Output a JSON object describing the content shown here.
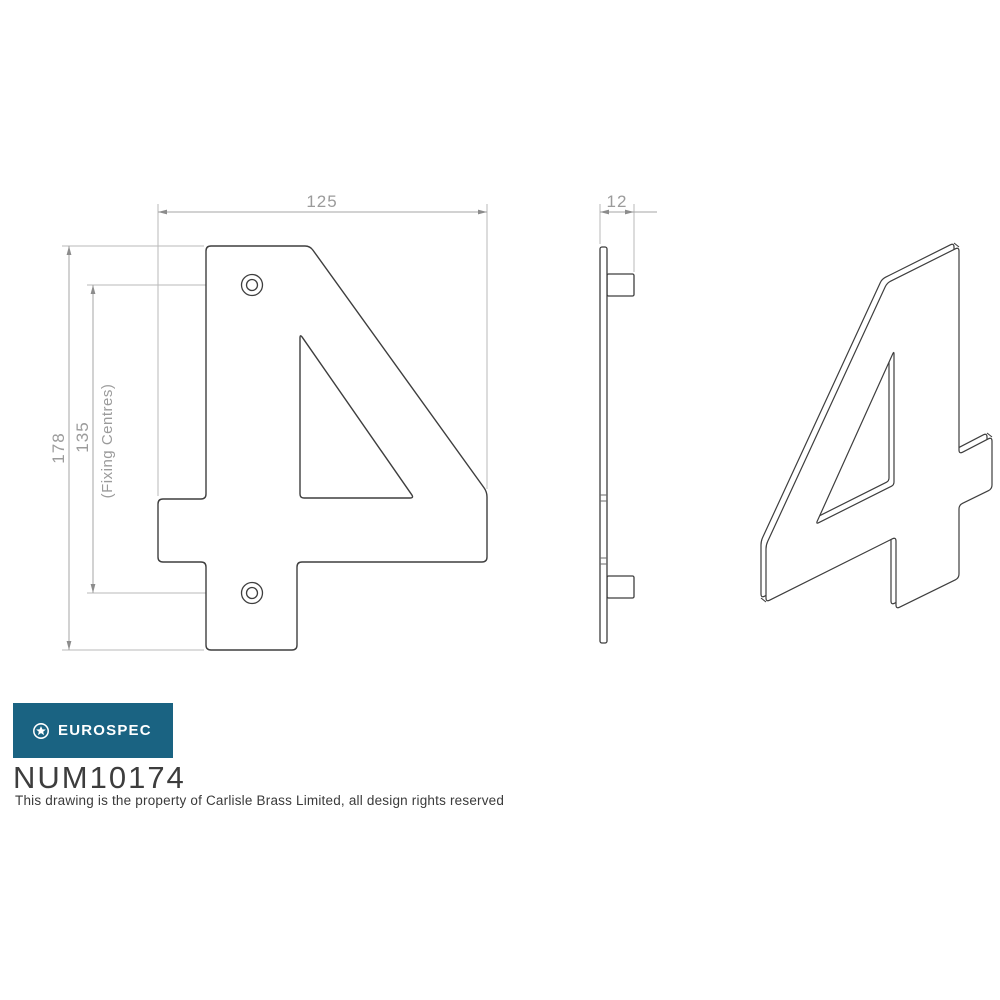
{
  "colors": {
    "outline": "#3e3e3e",
    "dim_line": "#a6a6a6",
    "ext_line": "#bababa",
    "arrow": "#8c8c8c",
    "dim_text": "#9b9b9b",
    "logo_bg": "#1a6382",
    "logo_text": "#ffffff",
    "code_text": "#3d3d3d",
    "footer_text": "#3a3a3a",
    "face_fill": "#ffffff"
  },
  "dims": {
    "width": {
      "label": "125",
      "line": [
        [
          158,
          212
        ],
        [
          487,
          212
        ]
      ],
      "arrows": [
        [
          [
            158,
            212
          ],
          180
        ],
        [
          [
            487,
            212
          ],
          0
        ]
      ],
      "ext": [
        [
          [
            158,
            204
          ],
          [
            158,
            496
          ]
        ],
        [
          [
            487,
            204
          ],
          [
            487,
            489
          ]
        ]
      ]
    },
    "thickness": {
      "label": "12",
      "line": [
        [
          600,
          212
        ],
        [
          657,
          212
        ]
      ],
      "arrows": [
        [
          [
            600,
            212
          ],
          180
        ],
        [
          [
            634,
            212
          ],
          0
        ]
      ],
      "ext": [
        [
          [
            600,
            204
          ],
          [
            600,
            244
          ]
        ],
        [
          [
            634,
            204
          ],
          [
            634,
            272
          ]
        ]
      ]
    },
    "height": {
      "label": "178",
      "line": [
        [
          69,
          246
        ],
        [
          69,
          650
        ]
      ],
      "arrows": [
        [
          [
            69,
            246
          ],
          270
        ],
        [
          [
            69,
            650
          ],
          90
        ]
      ],
      "ext": [
        [
          [
            62,
            246
          ],
          [
            204,
            246
          ]
        ],
        [
          [
            62,
            650
          ],
          [
            204,
            650
          ]
        ]
      ]
    },
    "centres": {
      "label": "135",
      "line": [
        [
          93,
          285
        ],
        [
          93,
          593
        ]
      ],
      "arrows": [
        [
          [
            93,
            285
          ],
          270
        ],
        [
          [
            93,
            593
          ],
          90
        ]
      ],
      "ext": [
        [
          [
            87,
            285
          ],
          [
            242,
            285
          ]
        ],
        [
          [
            87,
            593
          ],
          [
            242,
            593
          ]
        ]
      ]
    },
    "centres_note": {
      "label": "(Fixing Centres)"
    }
  },
  "views": {
    "front": {
      "outer": [
        [
          206,
          246
        ],
        [
          310,
          246
        ],
        [
          487,
          492
        ],
        [
          487,
          562
        ],
        [
          297,
          562
        ],
        [
          297,
          650
        ],
        [
          206,
          650
        ],
        [
          206,
          562
        ],
        [
          158,
          562
        ],
        [
          158,
          499
        ],
        [
          206,
          499
        ]
      ],
      "hole": [
        [
          300,
          334
        ],
        [
          414,
          498
        ],
        [
          300,
          498
        ]
      ],
      "corner_radius": 5,
      "hole_corner_radius": 4,
      "screw_holes": [
        {
          "cx": 252,
          "cy": 285
        },
        {
          "cx": 252,
          "cy": 593
        }
      ],
      "screw_r_outer": 10.5,
      "screw_r_inner": 5.5
    },
    "side": {
      "plate": [
        600,
        247,
        7,
        396
      ],
      "studs": [
        [
          607,
          274,
          27,
          22
        ],
        [
          607,
          576,
          27,
          22
        ]
      ],
      "ticks": [
        [
          600,
          495,
          607,
          495
        ],
        [
          600,
          501,
          607,
          501
        ],
        [
          600,
          558,
          607,
          558
        ],
        [
          600,
          564,
          607,
          564
        ]
      ]
    },
    "iso": {
      "outer": [
        [
          959,
          247
        ],
        [
          887,
          283
        ],
        [
          766,
          545
        ],
        [
          766,
          602
        ],
        [
          896,
          537
        ],
        [
          896,
          609
        ],
        [
          959,
          578
        ],
        [
          959,
          505
        ],
        [
          992,
          489
        ],
        [
          992,
          437
        ],
        [
          959,
          454
        ]
      ],
      "hole": [
        [
          894,
          351
        ],
        [
          816,
          524
        ],
        [
          894,
          485
        ]
      ],
      "depth": [
        -5,
        -4
      ],
      "corner_radius": 4,
      "hole_corner_radius": 3,
      "connectors": [
        [
          959,
          247
        ],
        [
          766,
          602
        ],
        [
          992,
          437
        ]
      ]
    }
  },
  "branding": {
    "logo_label": "EUROSPEC",
    "product_code": "NUM10174",
    "footer": "This drawing is the property of Carlisle Brass Limited, all design rights reserved"
  }
}
